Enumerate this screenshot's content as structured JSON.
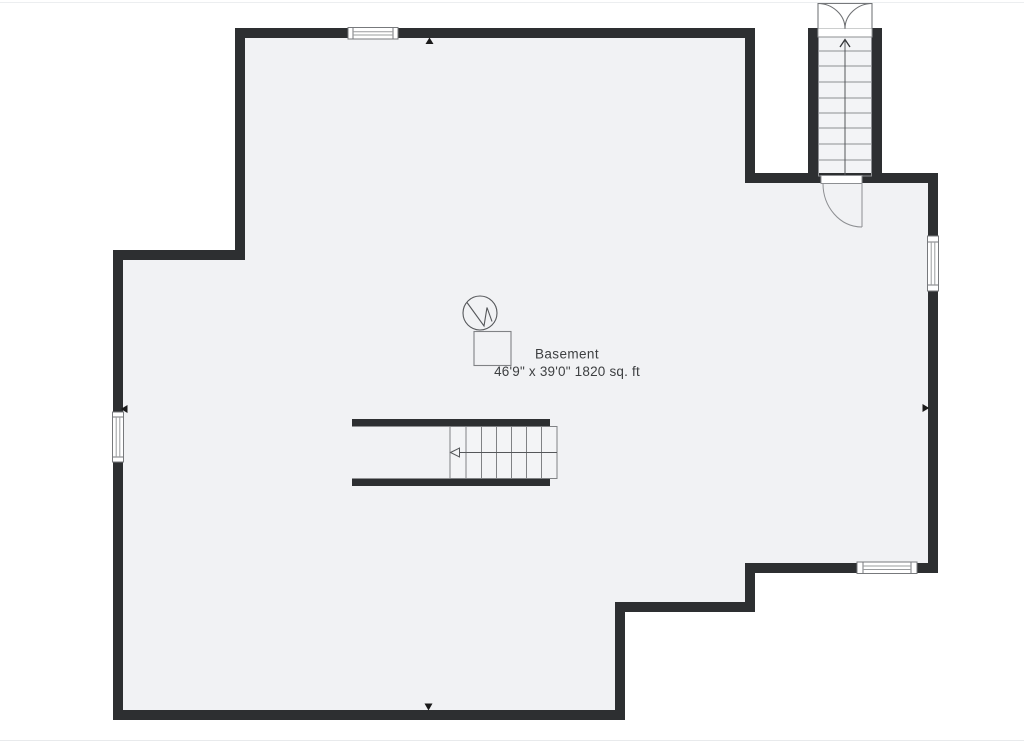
{
  "floorplan": {
    "room": {
      "label": "Basement",
      "dimensions": "46'9\" x 39'0\" 1820 sq. ft"
    },
    "colors": {
      "wall": "#2d2f31",
      "floor": "#f1f2f4",
      "stair_tread": "#f3f4f6",
      "detail_line": "#6f7174",
      "text": "#3d3f41",
      "background": "#ffffff",
      "marker": "#1a1a1a"
    },
    "features": {
      "windows": [
        "top-wall-window",
        "left-wall-window",
        "right-wall-window",
        "bottom-right-window"
      ],
      "doors": [
        "bulkhead-double-door",
        "stairwell-door"
      ],
      "stairs": [
        "bulkhead-staircase",
        "main-staircase"
      ],
      "symbols": [
        "water-heater-icon",
        "utility-unit",
        "wall-marker-top",
        "wall-marker-left",
        "wall-marker-right",
        "wall-marker-bottom"
      ]
    }
  }
}
